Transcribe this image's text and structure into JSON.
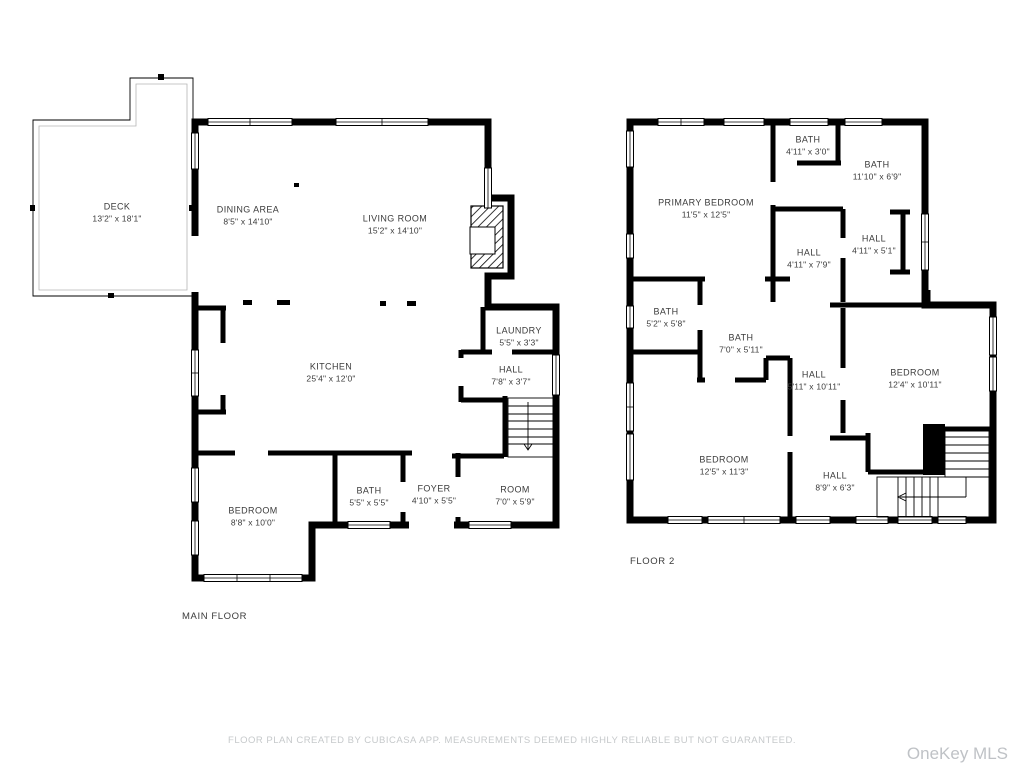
{
  "page": {
    "background_color": "#ffffff",
    "wall_color": "#000000",
    "label_color": "#3b3b3b",
    "muted_text_color": "#c6c9cb",
    "watermark_color": "#bfc2c6"
  },
  "floors": [
    {
      "label": "MAIN FLOOR",
      "rooms": [
        {
          "name": "DECK",
          "dims": "13'2\" x 18'1\""
        },
        {
          "name": "DINING AREA",
          "dims": "8'5\" x 14'10\""
        },
        {
          "name": "LIVING ROOM",
          "dims": "15'2\" x 14'10\""
        },
        {
          "name": "KITCHEN",
          "dims": "25'4\" x 12'0\""
        },
        {
          "name": "LAUNDRY",
          "dims": "5'5\" x 3'3\""
        },
        {
          "name": "HALL",
          "dims": "7'8\" x 3'7\""
        },
        {
          "name": "BEDROOM",
          "dims": "8'8\" x 10'0\""
        },
        {
          "name": "BATH",
          "dims": "5'5\" x 5'5\""
        },
        {
          "name": "FOYER",
          "dims": "4'10\" x 5'5\""
        },
        {
          "name": "ROOM",
          "dims": "7'0\" x 5'9\""
        }
      ]
    },
    {
      "label": "FLOOR 2",
      "rooms": [
        {
          "name": "PRIMARY BEDROOM",
          "dims": "11'5\" x 12'5\""
        },
        {
          "name": "BATH",
          "dims": "4'11\" x 3'0\""
        },
        {
          "name": "BATH",
          "dims": "11'10\" x 6'9\""
        },
        {
          "name": "HALL",
          "dims": "4'11\" x 7'9\""
        },
        {
          "name": "HALL",
          "dims": "4'11\" x 5'1\""
        },
        {
          "name": "BATH",
          "dims": "5'2\" x 5'8\""
        },
        {
          "name": "BATH",
          "dims": "7'0\" x 5'11\""
        },
        {
          "name": "HALL",
          "dims": "5'11\" x 10'11\""
        },
        {
          "name": "BEDROOM",
          "dims": "12'4\" x 10'11\""
        },
        {
          "name": "BEDROOM",
          "dims": "12'5\" x 11'3\""
        },
        {
          "name": "HALL",
          "dims": "8'9\" x 6'3\""
        }
      ]
    }
  ],
  "footer": {
    "disclaimer": "FLOOR PLAN CREATED BY CUBICASA APP. MEASUREMENTS DEEMED HIGHLY RELIABLE BUT NOT GUARANTEED."
  },
  "watermark": {
    "text": "OneKey MLS"
  }
}
